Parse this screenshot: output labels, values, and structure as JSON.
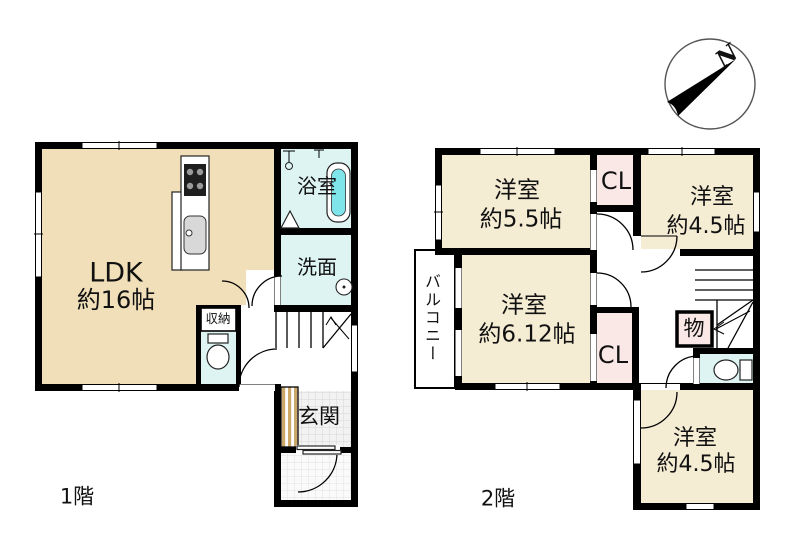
{
  "title": "2-story house floor plan",
  "floor1": {
    "floor_label": "1階",
    "ldk": {
      "line1": "LDK",
      "line2": "約16帖"
    },
    "bath": {
      "label": "浴室"
    },
    "wash": {
      "label": "洗面"
    },
    "storage": {
      "label": "収納"
    },
    "entrance": {
      "label": "玄関"
    }
  },
  "floor2": {
    "floor_label": "2階",
    "room_5_5": {
      "line1": "洋室",
      "line2": "約5.5帖"
    },
    "cl_top": {
      "label": "CL"
    },
    "room_4_5_top": {
      "line1": "洋室",
      "line2": "約4.5帖"
    },
    "balcony": {
      "label": "バルコニー"
    },
    "room_6_12": {
      "line1": "洋室",
      "line2": "約6.12帖"
    },
    "cl_bottom": {
      "label": "CL"
    },
    "storage": {
      "label": "物"
    },
    "room_4_5_bottom": {
      "line1": "洋室",
      "line2": "約4.5帖"
    }
  },
  "compass": {
    "label": "N"
  },
  "colors": {
    "wall": "#000000",
    "cream_1f": "#F0DFB8",
    "cream_2f": "#F5ECD4",
    "wet_cyan": "#DDF4F3",
    "tub_water": "#7FE5EA",
    "closet_pink": "#F9E8E6",
    "stripe_tan": "#CBA768",
    "compass_stroke": "#555555"
  }
}
